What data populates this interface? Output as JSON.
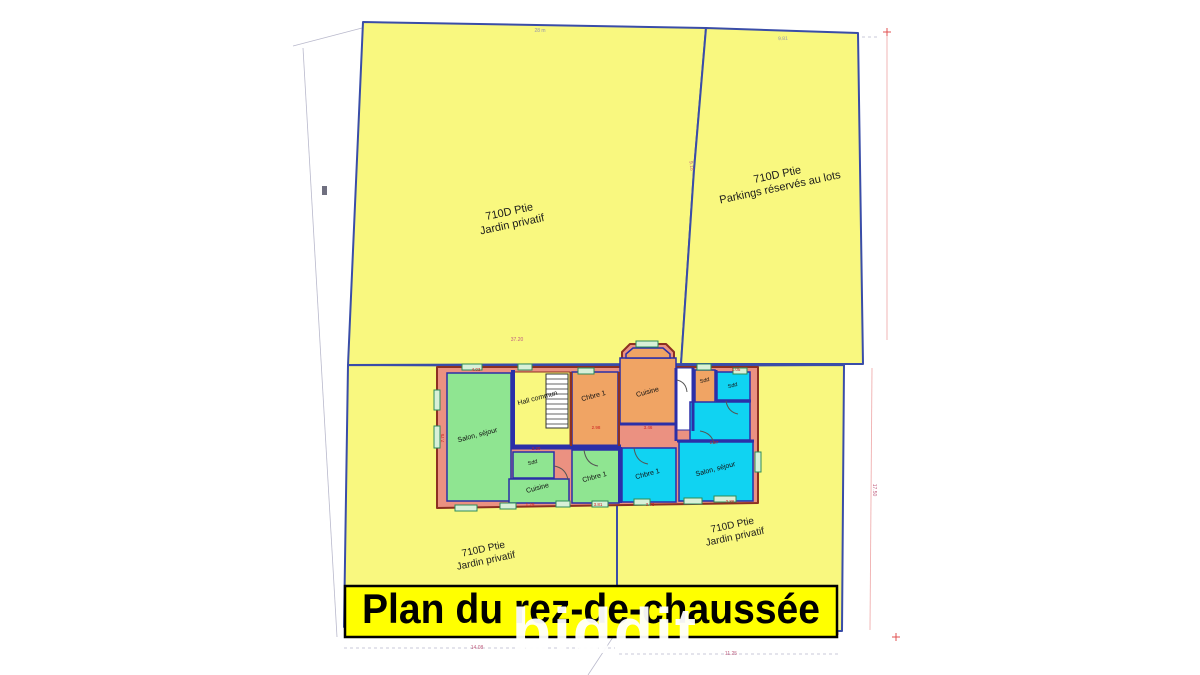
{
  "banner": {
    "title": "Plan du rez-de-chaussée"
  },
  "watermark": {
    "text": "biddit"
  },
  "parcels": [
    {
      "id": "top-left",
      "line1": "710D Ptie",
      "line2": "Jardin privatif"
    },
    {
      "id": "top-right",
      "line1": "710D Ptie",
      "line2": "Parkings réservés au lots"
    },
    {
      "id": "bottom-left",
      "line1": "710D Ptie",
      "line2": "Jardin privatif"
    },
    {
      "id": "bottom-right",
      "line1": "710D Ptie",
      "line2": "Jardin privatif"
    }
  ],
  "building": {
    "units": [
      {
        "name": "left-unit",
        "color": "#8FE591",
        "rooms": [
          {
            "label": "Salon, séjour"
          },
          {
            "label": "Sdd"
          },
          {
            "label": "Cuisine"
          },
          {
            "label": "Chbre 1"
          }
        ]
      },
      {
        "name": "middle-unit",
        "color": "#F0A464",
        "rooms": [
          {
            "label": "Chbre 1"
          },
          {
            "label": "Cuisine"
          },
          {
            "label": "Sdd"
          }
        ]
      },
      {
        "name": "right-unit",
        "color": "#10D3F2",
        "rooms": [
          {
            "label": "Sdd"
          },
          {
            "label": "Chbre 1"
          },
          {
            "label": "Salon, séjour"
          }
        ]
      },
      {
        "name": "common",
        "color": "#F9F87F",
        "rooms": [
          {
            "label": "Hall commun"
          }
        ]
      }
    ]
  },
  "dimension_labels": [
    {
      "text": "28 m",
      "x": 540,
      "y": 32,
      "rot": 0,
      "color": "#9595AC",
      "size": 5
    },
    {
      "text": "9.81",
      "x": 783,
      "y": 40,
      "rot": -2,
      "color": "#9595AC",
      "size": 5
    },
    {
      "text": "9.18",
      "x": 690,
      "y": 166,
      "rot": 83,
      "color": "#C06080",
      "size": 5
    },
    {
      "text": "37.20",
      "x": 517,
      "y": 341,
      "rot": 0,
      "color": "#C06080",
      "size": 5
    },
    {
      "text": "14.08",
      "x": 477,
      "y": 649,
      "rot": 0,
      "color": "#C06080",
      "size": 5
    },
    {
      "text": "11.25",
      "x": 731,
      "y": 655,
      "rot": 0,
      "color": "#C06080",
      "size": 5
    },
    {
      "text": "17.50",
      "x": 873,
      "y": 490,
      "rot": 90,
      "color": "#C06080",
      "size": 5
    },
    {
      "text": "4.03",
      "x": 476,
      "y": 371,
      "rot": 0,
      "color": "#CC2020",
      "size": 4.5
    },
    {
      "text": "7.75",
      "x": 444,
      "y": 438,
      "rot": -90,
      "color": "#CC2020",
      "size": 4.5
    },
    {
      "text": "2.98",
      "x": 596,
      "y": 429,
      "rot": 0,
      "color": "#CC2020",
      "size": 4.5
    },
    {
      "text": "3.46",
      "x": 648,
      "y": 429,
      "rot": 0,
      "color": "#CC2020",
      "size": 4.5
    },
    {
      "text": "2.20",
      "x": 536,
      "y": 450,
      "rot": 0,
      "color": "#CC2020",
      "size": 4.5
    },
    {
      "text": "1.29",
      "x": 530,
      "y": 506,
      "rot": 0,
      "color": "#CC2020",
      "size": 4.5
    },
    {
      "text": "3.81",
      "x": 598,
      "y": 506,
      "rot": 0,
      "color": "#CC2020",
      "size": 4.5
    },
    {
      "text": "3.73",
      "x": 650,
      "y": 506,
      "rot": 0,
      "color": "#CC2020",
      "size": 4.5
    },
    {
      "text": "2.97",
      "x": 714,
      "y": 444,
      "rot": 0,
      "color": "#CC2020",
      "size": 4.5
    },
    {
      "text": "1.05",
      "x": 736,
      "y": 371,
      "rot": 0,
      "color": "#CC2020",
      "size": 4.5
    },
    {
      "text": "2.86",
      "x": 730,
      "y": 503,
      "rot": 0,
      "color": "#CC2020",
      "size": 4.5
    }
  ],
  "colors": {
    "parcel_fill": "#F9F87F",
    "parcel_stroke": "#3A4DA8",
    "wall_fill": "#EB9181",
    "wall_stroke": "#8C3022",
    "interior_wall": "#2B2FA8",
    "banner_fill": "#FFFF00",
    "banner_text": "#000000",
    "watermark": "#FFFFFF"
  }
}
